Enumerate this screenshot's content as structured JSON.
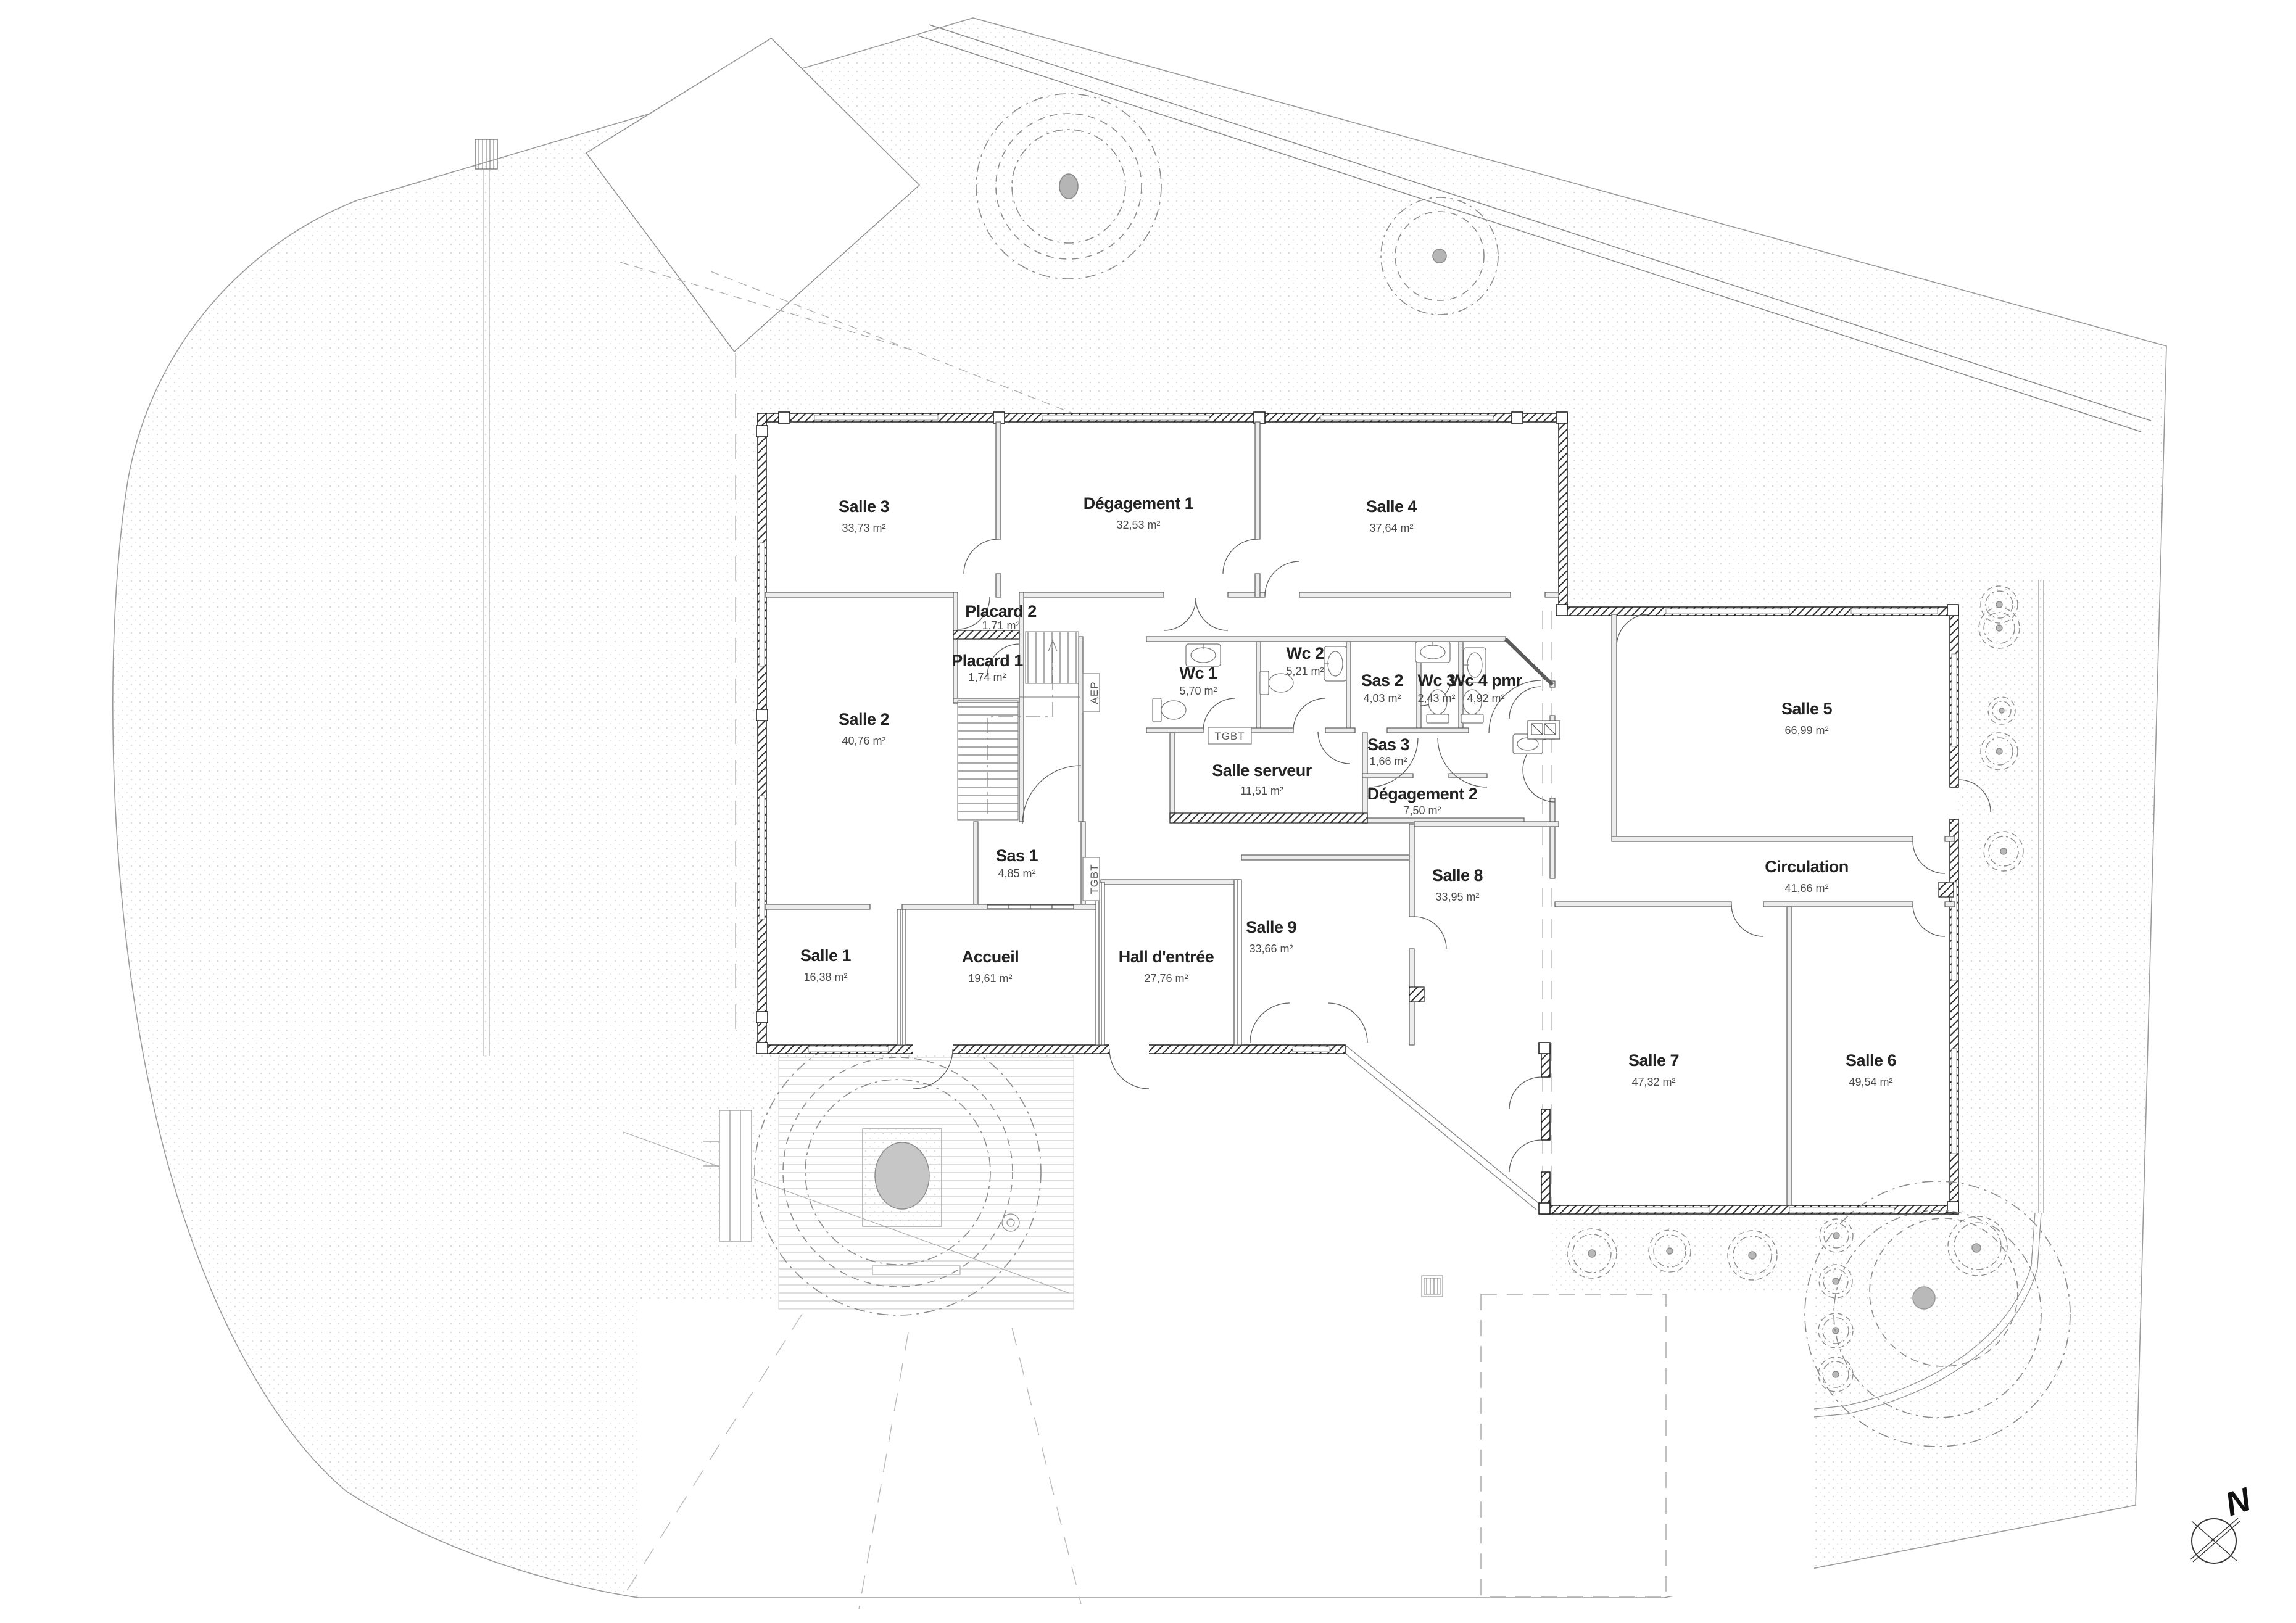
{
  "drawing": {
    "type": "architectural floor plan",
    "north_label": "N"
  },
  "rooms": [
    {
      "name": "Salle 3",
      "area": "33,73 m²"
    },
    {
      "name": "Dégagement 1",
      "area": "32,53 m²"
    },
    {
      "name": "Salle 4",
      "area": "37,64 m²"
    },
    {
      "name": "Placard 2",
      "area": "1,71 m²"
    },
    {
      "name": "Placard 1",
      "area": "1,74 m²"
    },
    {
      "name": "Wc 1",
      "area": "5,70 m²"
    },
    {
      "name": "Wc 2",
      "area": "5,21 m²"
    },
    {
      "name": "Sas 2",
      "area": "4,03 m²"
    },
    {
      "name": "Wc 3",
      "area": "2,43 m²"
    },
    {
      "name": "Wc 4 pmr",
      "area": "4,92 m²"
    },
    {
      "name": "Salle 2",
      "area": "40,76 m²"
    },
    {
      "name": "Sas 3",
      "area": "1,66 m²"
    },
    {
      "name": "Salle serveur",
      "area": "11,51 m²"
    },
    {
      "name": "Dégagement 2",
      "area": "7,50 m²"
    },
    {
      "name": "Salle 5",
      "area": "66,99 m²"
    },
    {
      "name": "Sas 1",
      "area": "4,85 m²"
    },
    {
      "name": "Salle 8",
      "area": "33,95 m²"
    },
    {
      "name": "Circulation",
      "area": "41,66 m²"
    },
    {
      "name": "Salle 1",
      "area": "16,38 m²"
    },
    {
      "name": "Accueil",
      "area": "19,61 m²"
    },
    {
      "name": "Hall d'entrée",
      "area": "27,76 m²"
    },
    {
      "name": "Salle 9",
      "area": "33,66 m²"
    },
    {
      "name": "Salle 7",
      "area": "47,32 m²"
    },
    {
      "name": "Salle 6",
      "area": "49,54 m²"
    }
  ],
  "equipment": {
    "tgbt_horizontal": "TGBT",
    "tgbt_vertical": "TGBT",
    "aep": "AEP"
  },
  "colors": {
    "wall_outline": "#1f1f1f",
    "interior_wall": "#5a5a5a",
    "tree_line": "#8c8c8c",
    "tree_fill": "#b5b5b5",
    "text": "#232323"
  }
}
